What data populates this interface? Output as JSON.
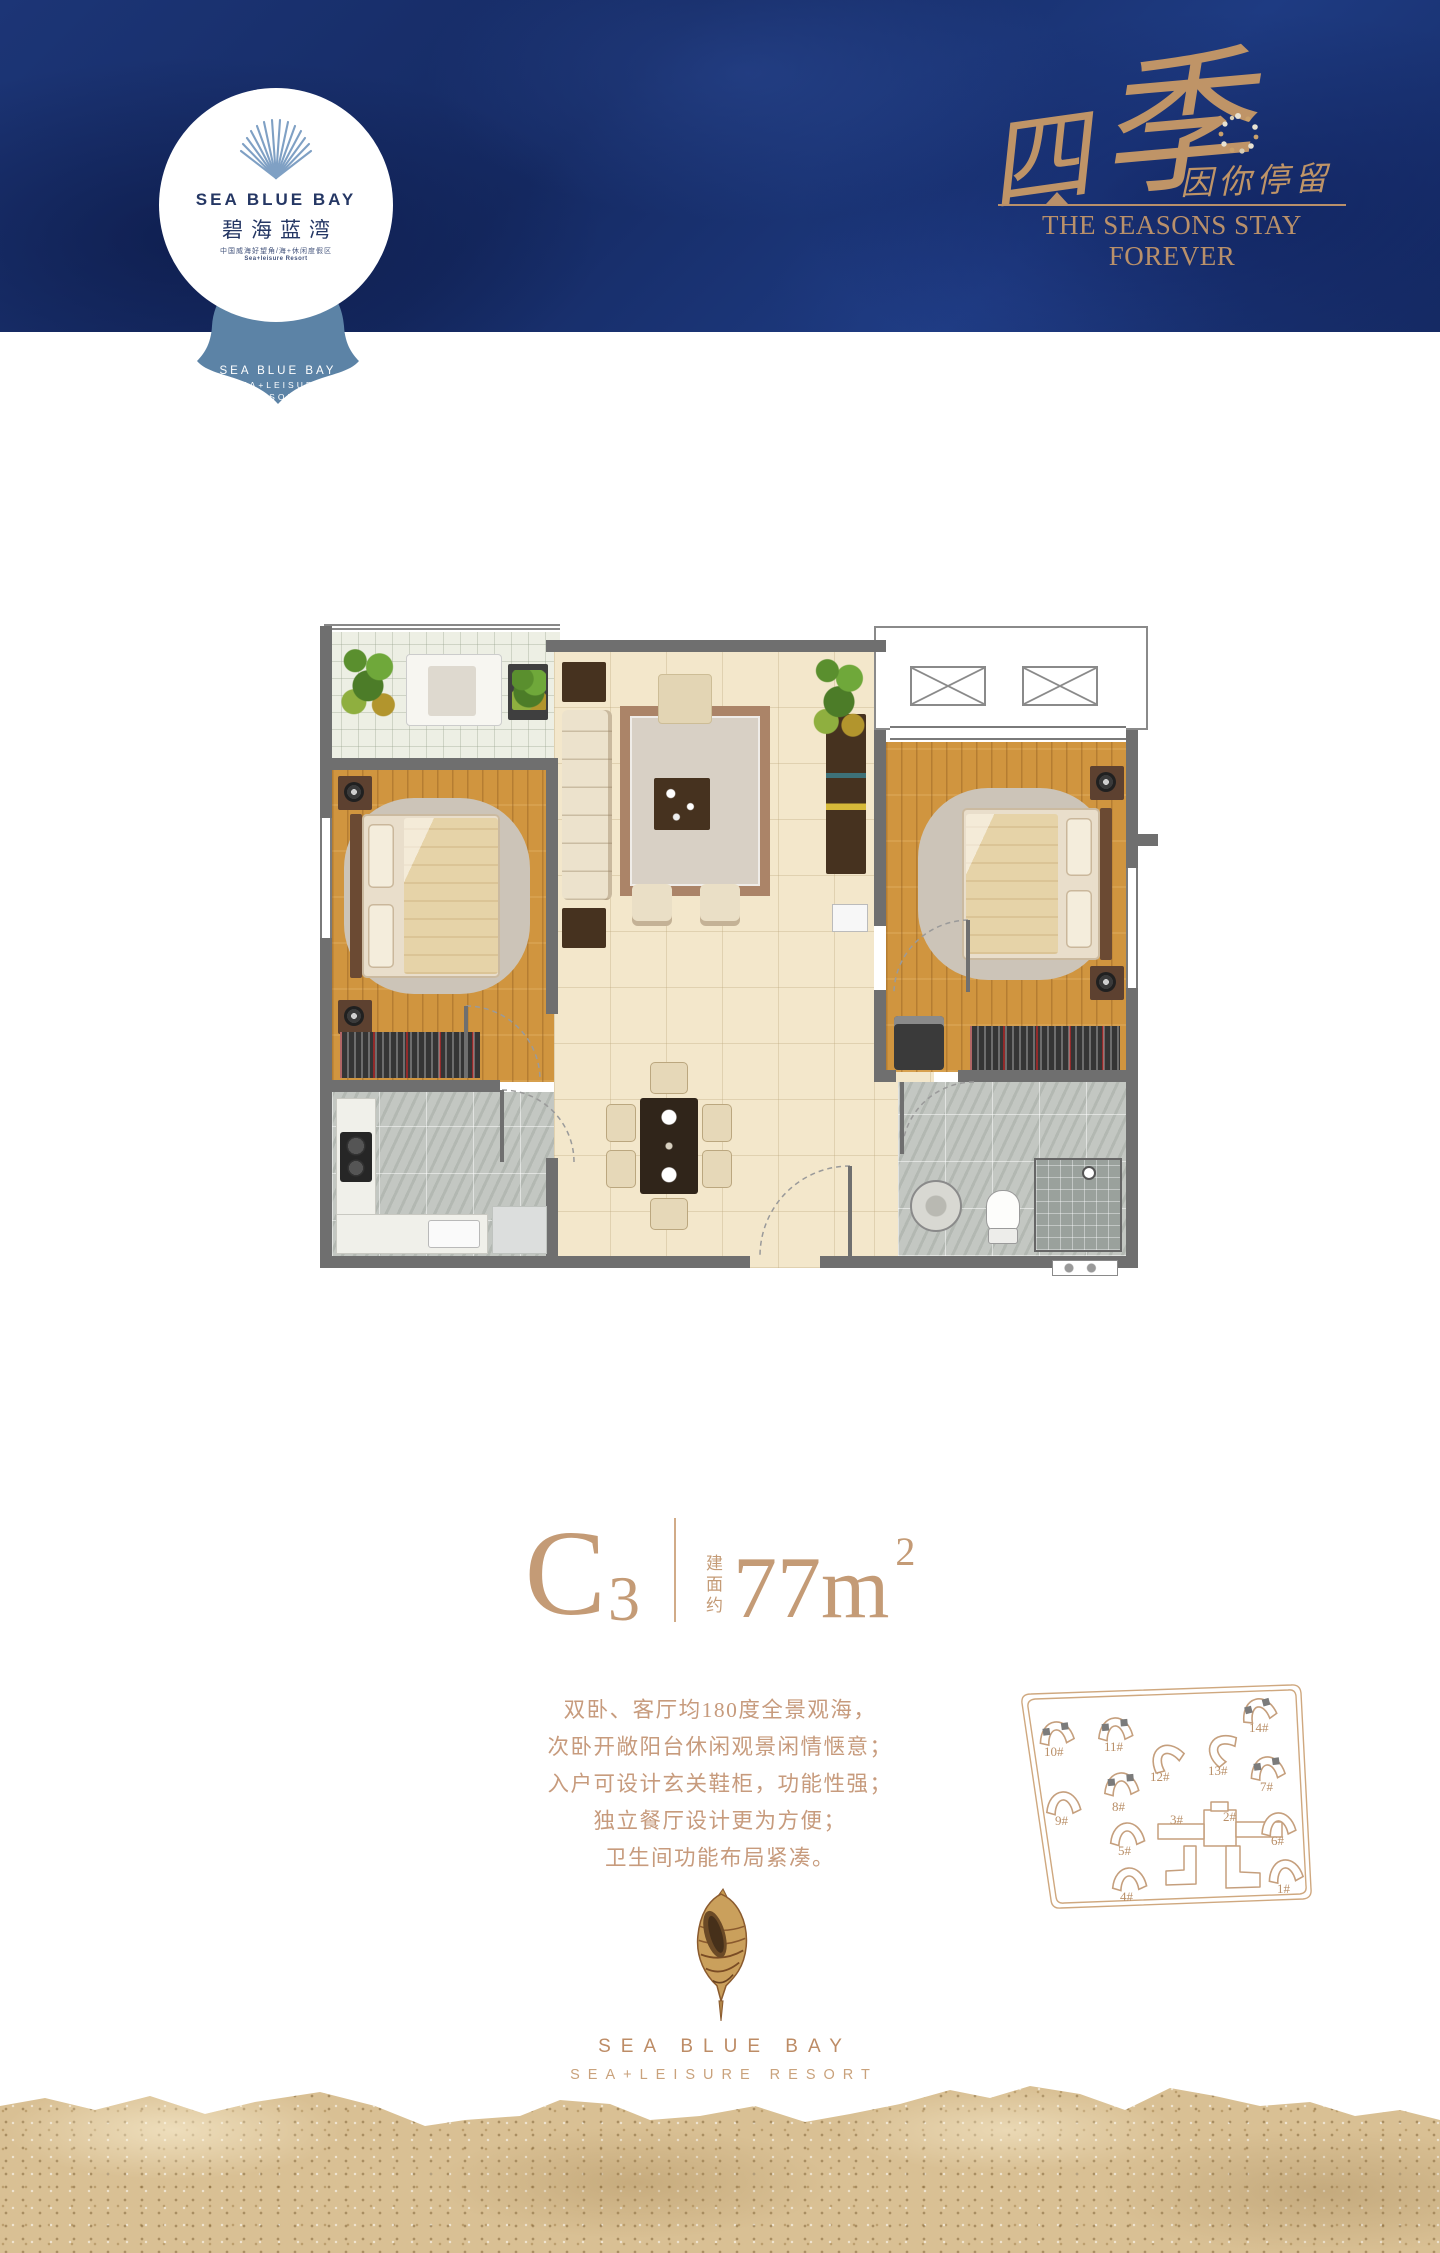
{
  "header": {
    "logo": {
      "brand_en": "SEA BLUE BAY",
      "brand_cn": "碧海蓝湾",
      "tagline_cn": "中国威海好望角/海+休闲度假区",
      "tagline_en": "Sea+leisure Resort"
    },
    "badge": {
      "line1": "SEA BLUE BAY",
      "line2": "SEA+LEISURE",
      "line3": "RESORT"
    },
    "slogan": {
      "calligraphy_char1": "四",
      "calligraphy_char2": "季",
      "stamp_text": "因你停留",
      "english": "THE SEASONS STAY FOREVER"
    }
  },
  "unit": {
    "code_letter": "C",
    "code_digit": "3",
    "area_label_chars": [
      "建",
      "面",
      "约"
    ],
    "area_value": "77",
    "area_unit": "m",
    "area_exponent": "2"
  },
  "description": {
    "lines": [
      "双卧、客厅均180度全景观海，",
      "次卧开敞阳台休闲观景闲情惬意；",
      "入户可设计玄关鞋柜，功能性强；",
      "独立餐厅设计更为方便；",
      "卫生间功能布局紧凑。"
    ]
  },
  "siteplan": {
    "buildings": [
      {
        "label": "10#",
        "x": 58,
        "y": 80,
        "rot": -8,
        "marked": true,
        "lx": 46,
        "ly": 104
      },
      {
        "label": "11#",
        "x": 117,
        "y": 76,
        "rot": -5,
        "marked": true,
        "lx": 106,
        "ly": 99
      },
      {
        "label": "14#",
        "x": 260,
        "y": 57,
        "rot": -15,
        "marked": true,
        "lx": 251,
        "ly": 80
      },
      {
        "label": "12#",
        "x": 167,
        "y": 104,
        "rot": -35,
        "marked": false,
        "lx": 152,
        "ly": 129
      },
      {
        "label": "13#",
        "x": 222,
        "y": 96,
        "rot": -60,
        "marked": false,
        "lx": 210,
        "ly": 123
      },
      {
        "label": "7#",
        "x": 269,
        "y": 115,
        "rot": -8,
        "marked": true,
        "lx": 262,
        "ly": 139
      },
      {
        "label": "8#",
        "x": 123,
        "y": 131,
        "rot": -5,
        "marked": true,
        "lx": 114,
        "ly": 159
      },
      {
        "label": "9#",
        "x": 65,
        "y": 150,
        "rot": -5,
        "marked": false,
        "lx": 57,
        "ly": 173
      },
      {
        "label": "5#",
        "x": 129,
        "y": 181,
        "rot": -4,
        "marked": false,
        "lx": 120,
        "ly": 203
      },
      {
        "label": "6#",
        "x": 280,
        "y": 171,
        "rot": -6,
        "marked": false,
        "lx": 273,
        "ly": 193
      },
      {
        "label": "3#",
        "chevron": false,
        "lx": 172,
        "ly": 172
      },
      {
        "label": "2#",
        "chevron": false,
        "lx": 225,
        "ly": 169
      },
      {
        "label": "4#",
        "x": 131,
        "y": 226,
        "rot": -4,
        "marked": false,
        "lx": 122,
        "ly": 249
      },
      {
        "label": "1#",
        "x": 287,
        "y": 218,
        "rot": -8,
        "marked": false,
        "lx": 279,
        "ly": 241
      }
    ]
  },
  "footer": {
    "brand_en": "SEA BLUE BAY",
    "resort_line": "SEA+LEISURE RESORT"
  },
  "colors": {
    "navy": "#16306c",
    "badge_blue": "#5c83a6",
    "gold": "#bf9467",
    "tan_text": "#c79b7d",
    "wall_gray": "#6f6f6f",
    "wood": "#d0953f",
    "tile_beige": "#f3e7cb",
    "sand": "#d9c094"
  }
}
